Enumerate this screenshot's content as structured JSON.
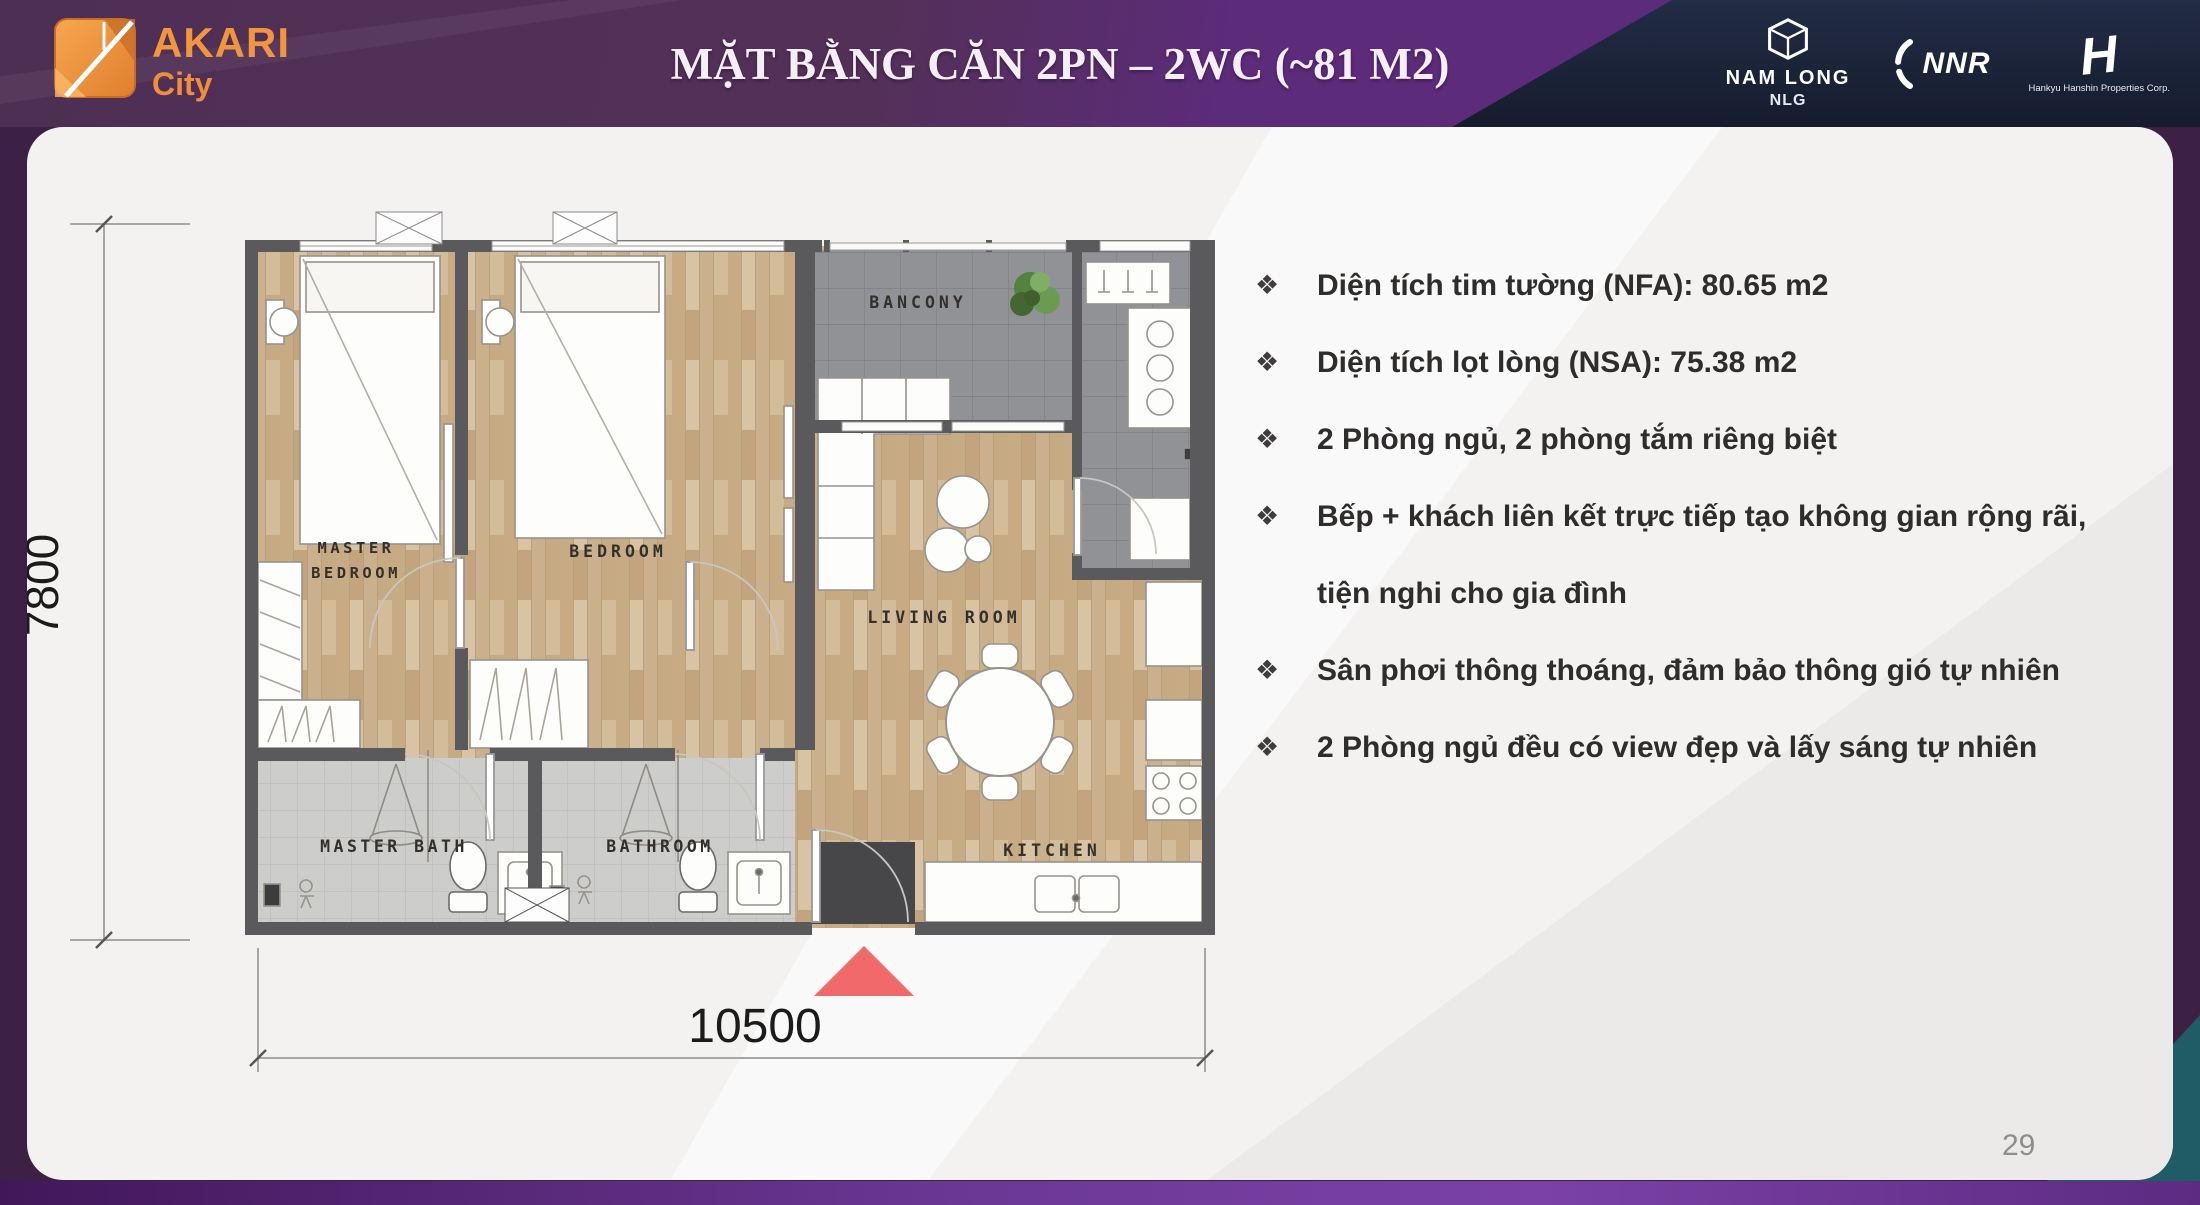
{
  "header": {
    "logo": {
      "name": "AKARI",
      "city": "City"
    },
    "title": "MẶT BẰNG CĂN 2PN – 2WC (~81 M2)",
    "partners": {
      "nam_long_name": "NAM LONG",
      "nam_long_code": "NLG",
      "nnr": "NNR",
      "hankyu": "Hankyu Hanshin Properties Corp."
    }
  },
  "floor_plan": {
    "rooms": {
      "master_bedroom_line1": "MASTER",
      "master_bedroom_line2": "BEDROOM",
      "bedroom": "BEDROOM",
      "balcony": "BANCONY",
      "living_room": "LIVING ROOM",
      "master_bath": "MASTER BATH",
      "bathroom": "BATHROOM",
      "kitchen": "KITCHEN"
    },
    "dimensions": {
      "width_mm": "10500",
      "height_mm": "7800"
    }
  },
  "features": {
    "bullet": "❖",
    "items": [
      "Diện tích tim tường (NFA): 80.65 m2",
      "Diện tích lọt lòng (NSA): 75.38 m2",
      "2 Phòng ngủ, 2 phòng tắm riêng biệt",
      "Bếp + khách liên kết trực tiếp tạo không gian rộng rãi, tiện nghi cho gia đình",
      "Sân phơi thông thoáng, đảm bảo thông gió tự nhiên",
      "2 Phòng ngủ đều có view đẹp và lấy sáng tự nhiên"
    ]
  },
  "page_number": "29",
  "colors": {
    "accent_orange": "#ef8f3c",
    "header_purple": "#5c2b7a",
    "header_navy": "#1d2436",
    "wall_gray": "#5a5a5c",
    "wood_floor": "#cdb493",
    "entrance_red": "#f0696b"
  }
}
